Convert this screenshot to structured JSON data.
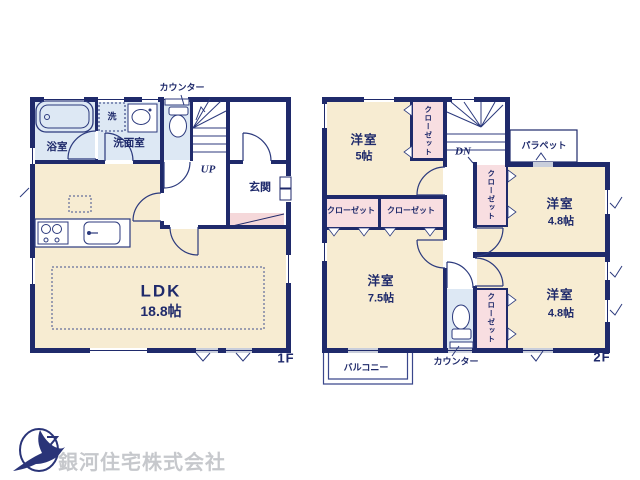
{
  "plan": {
    "floor1": {
      "floor_label": "1F",
      "counter": "カウンター",
      "stairs": "UP",
      "rooms": {
        "bath": "浴室",
        "washer": "洗",
        "washroom": "洗面室",
        "entrance": "玄関",
        "ldk_name": "LDK",
        "ldk_size": "18.8帖"
      }
    },
    "floor2": {
      "floor_label": "2F",
      "stairs": "DN",
      "counter": "カウンター",
      "parapet": "パラペット",
      "balcony": "バルコニー",
      "closet": "クローゼット",
      "rooms": {
        "room5_name": "洋室",
        "room5_size": "5帖",
        "room48a_name": "洋室",
        "room48a_size": "4.8帖",
        "room48b_name": "洋室",
        "room48b_size": "4.8帖",
        "room75_name": "洋室",
        "room75_size": "7.5帖"
      }
    }
  },
  "branding": {
    "company": "銀河住宅株式会社"
  },
  "colors": {
    "wall_navy": "#1f2a6b",
    "room_cream": "#f7ecd2",
    "closet_pink": "#f8dee1",
    "wet_area_blue": "#dde8f4",
    "entry_step_pink": "#f5d8da",
    "window_gray": "#c9cedb",
    "logo_blue": "#2a3478",
    "company_gray": "#c6c8cc"
  }
}
